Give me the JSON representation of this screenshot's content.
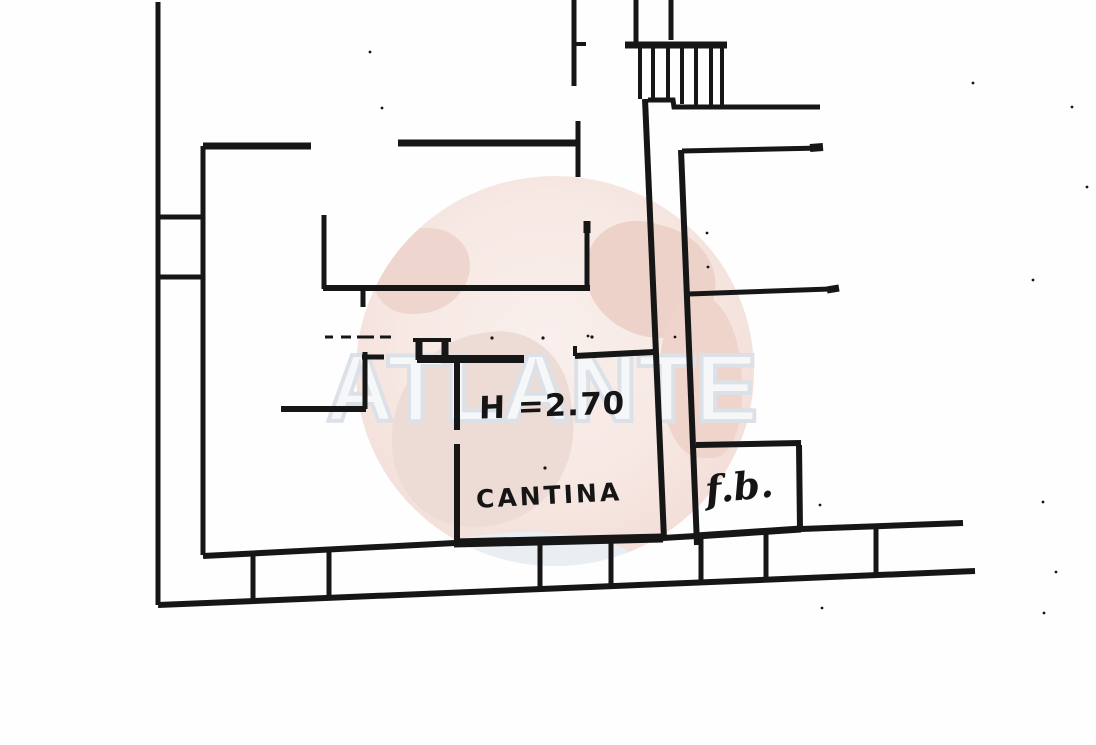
{
  "document": {
    "labels": {
      "ceiling_height": "H =2.70",
      "room_main": "CANTINA",
      "room_small": "f.b."
    }
  },
  "watermark": {
    "text": "ATLANTE"
  },
  "colors": {
    "ink": "#161616",
    "paper": "#fefefe",
    "globe_pink": "#f6e7e2",
    "continent_pink": "#ecd2c9",
    "letter_fill": "#f5f7f9",
    "letter_outline": "#dce1e8",
    "wash_blue": "#e9eef3"
  }
}
